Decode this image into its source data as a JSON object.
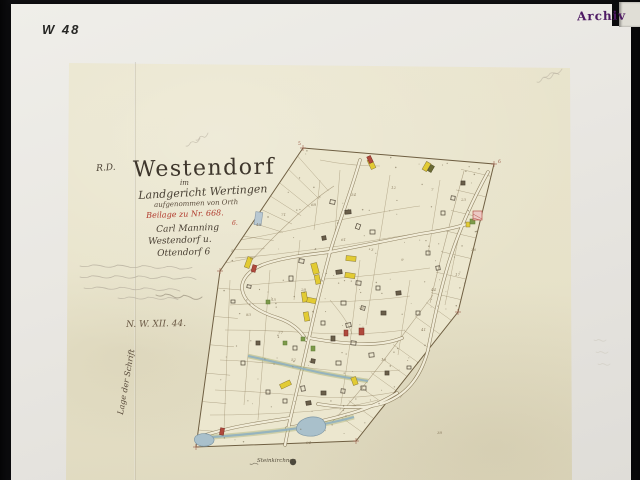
{
  "photo": {
    "shelf_mark": "W 48",
    "stamp": "Archiv"
  },
  "map": {
    "heading_initials": "R.D.",
    "title": "Westendorf",
    "line_im": "im",
    "line_court": "Landgericht Wertingen",
    "line_survey": "aufgenommen von Orth",
    "line_red": "Beilage zu Nr. 668.",
    "line_name": "Carl Manning",
    "line_place1": "Westendorf u.",
    "line_place2": "Ottendorf 6",
    "red_margin_mark": "6.",
    "archive_no": "N. W. XII. 44.",
    "side_note": "Lage der Schrift",
    "bottom_signature": "Steinkirchner",
    "corner_marks": [
      {
        "t": "5",
        "x": 298,
        "y": 145
      },
      {
        "t": "6",
        "x": 498,
        "y": 163
      }
    ],
    "parcel_numbers": [
      {
        "t": "48",
        "x": 256,
        "y": 226
      },
      {
        "t": "71",
        "x": 281,
        "y": 216
      },
      {
        "t": "68",
        "x": 311,
        "y": 206
      },
      {
        "t": "54",
        "x": 351,
        "y": 196
      },
      {
        "t": "12",
        "x": 391,
        "y": 189
      },
      {
        "t": "7",
        "x": 431,
        "y": 191
      },
      {
        "t": "23",
        "x": 461,
        "y": 201
      },
      {
        "t": "36",
        "x": 471,
        "y": 251
      },
      {
        "t": "17",
        "x": 455,
        "y": 276
      },
      {
        "t": "44",
        "x": 431,
        "y": 291
      },
      {
        "t": "9",
        "x": 401,
        "y": 261
      },
      {
        "t": "3",
        "x": 371,
        "y": 251
      },
      {
        "t": "61",
        "x": 341,
        "y": 241
      },
      {
        "t": "28",
        "x": 301,
        "y": 291
      },
      {
        "t": "15",
        "x": 271,
        "y": 301
      },
      {
        "t": "83",
        "x": 246,
        "y": 316
      },
      {
        "t": "52",
        "x": 291,
        "y": 361
      },
      {
        "t": "94",
        "x": 306,
        "y": 444
      },
      {
        "t": "19",
        "x": 381,
        "y": 361
      },
      {
        "t": "41",
        "x": 421,
        "y": 331
      },
      {
        "t": "38",
        "x": 437,
        "y": 434
      },
      {
        "t": "5",
        "x": 231,
        "y": 252
      },
      {
        "t": "26",
        "x": 359,
        "y": 309
      },
      {
        "t": "77",
        "x": 278,
        "y": 334
      }
    ]
  },
  "colors": {
    "backdrop": "#121214",
    "white_sheet": "#e9e7e2",
    "map_paper": "#e7e2c9",
    "map_paper_inner": "#ece7cf",
    "ink": "#40382e",
    "red_ink": "#b23c2e",
    "stamp_purple": "#4e1a63",
    "line_sepia": "#8a7a5a",
    "boundary": "#6f5f42",
    "road_fill": "#f1ecd8",
    "road_edge": "#7e6e4e",
    "building_yellow": "#e2cb33",
    "building_red": "#b0493c",
    "building_olive": "#6b6b35",
    "garden_green": "#7d9a4a",
    "water_blue": "#8fb0c0",
    "water_fill": "#a9c0cb",
    "fringe_green": "#9aa45f",
    "pencil": "#b5ae9e",
    "number_ink": "#7a6a4e"
  }
}
